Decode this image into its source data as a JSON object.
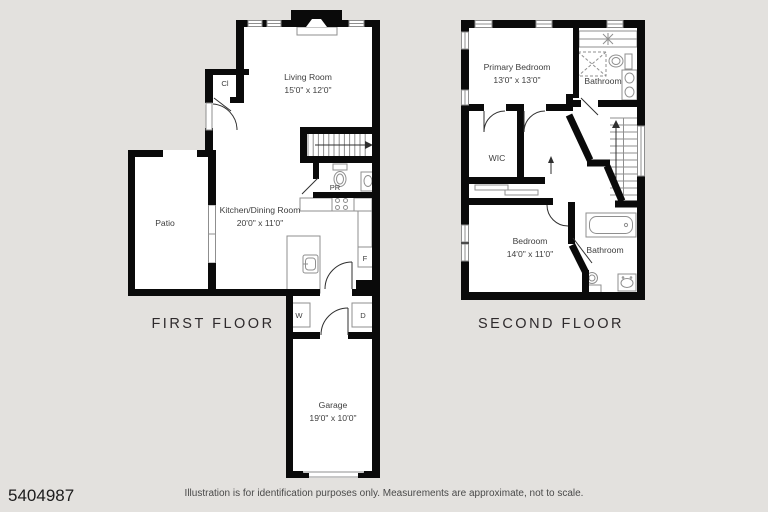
{
  "plans": {
    "first": {
      "title": "FIRST FLOOR",
      "rooms": {
        "living": {
          "name": "Living Room",
          "dims": "15'0\" x 12'0\""
        },
        "kitchen": {
          "name": "Kitchen/Dining Room",
          "dims": "20'0\" x 11'0\""
        },
        "patio": {
          "name": "Patio"
        },
        "garage": {
          "name": "Garage",
          "dims": "19'0\" x 10'0\""
        }
      },
      "labels": {
        "closet": "Cl",
        "powder_room": "PR",
        "fridge": "F",
        "washer": "W",
        "dryer": "D"
      }
    },
    "second": {
      "title": "SECOND FLOOR",
      "rooms": {
        "primary": {
          "name": "Primary Bedroom",
          "dims": "13'0\" x 13'0\""
        },
        "bath1": {
          "name": "Bathroom"
        },
        "wic": {
          "name": "WIC"
        },
        "bedroom": {
          "name": "Bedroom",
          "dims": "14'0\" x 11'0\""
        },
        "bath2": {
          "name": "Bathroom"
        }
      }
    }
  },
  "footer": {
    "id": "5404987",
    "disclaimer": "Illustration is for identification purposes only. Measurements are approximate, not to scale."
  },
  "colors": {
    "background": "#e3e1de",
    "wall": "#0a0a0a",
    "fixture_line": "#8f8f8f",
    "label_text": "#3e3e3e"
  }
}
